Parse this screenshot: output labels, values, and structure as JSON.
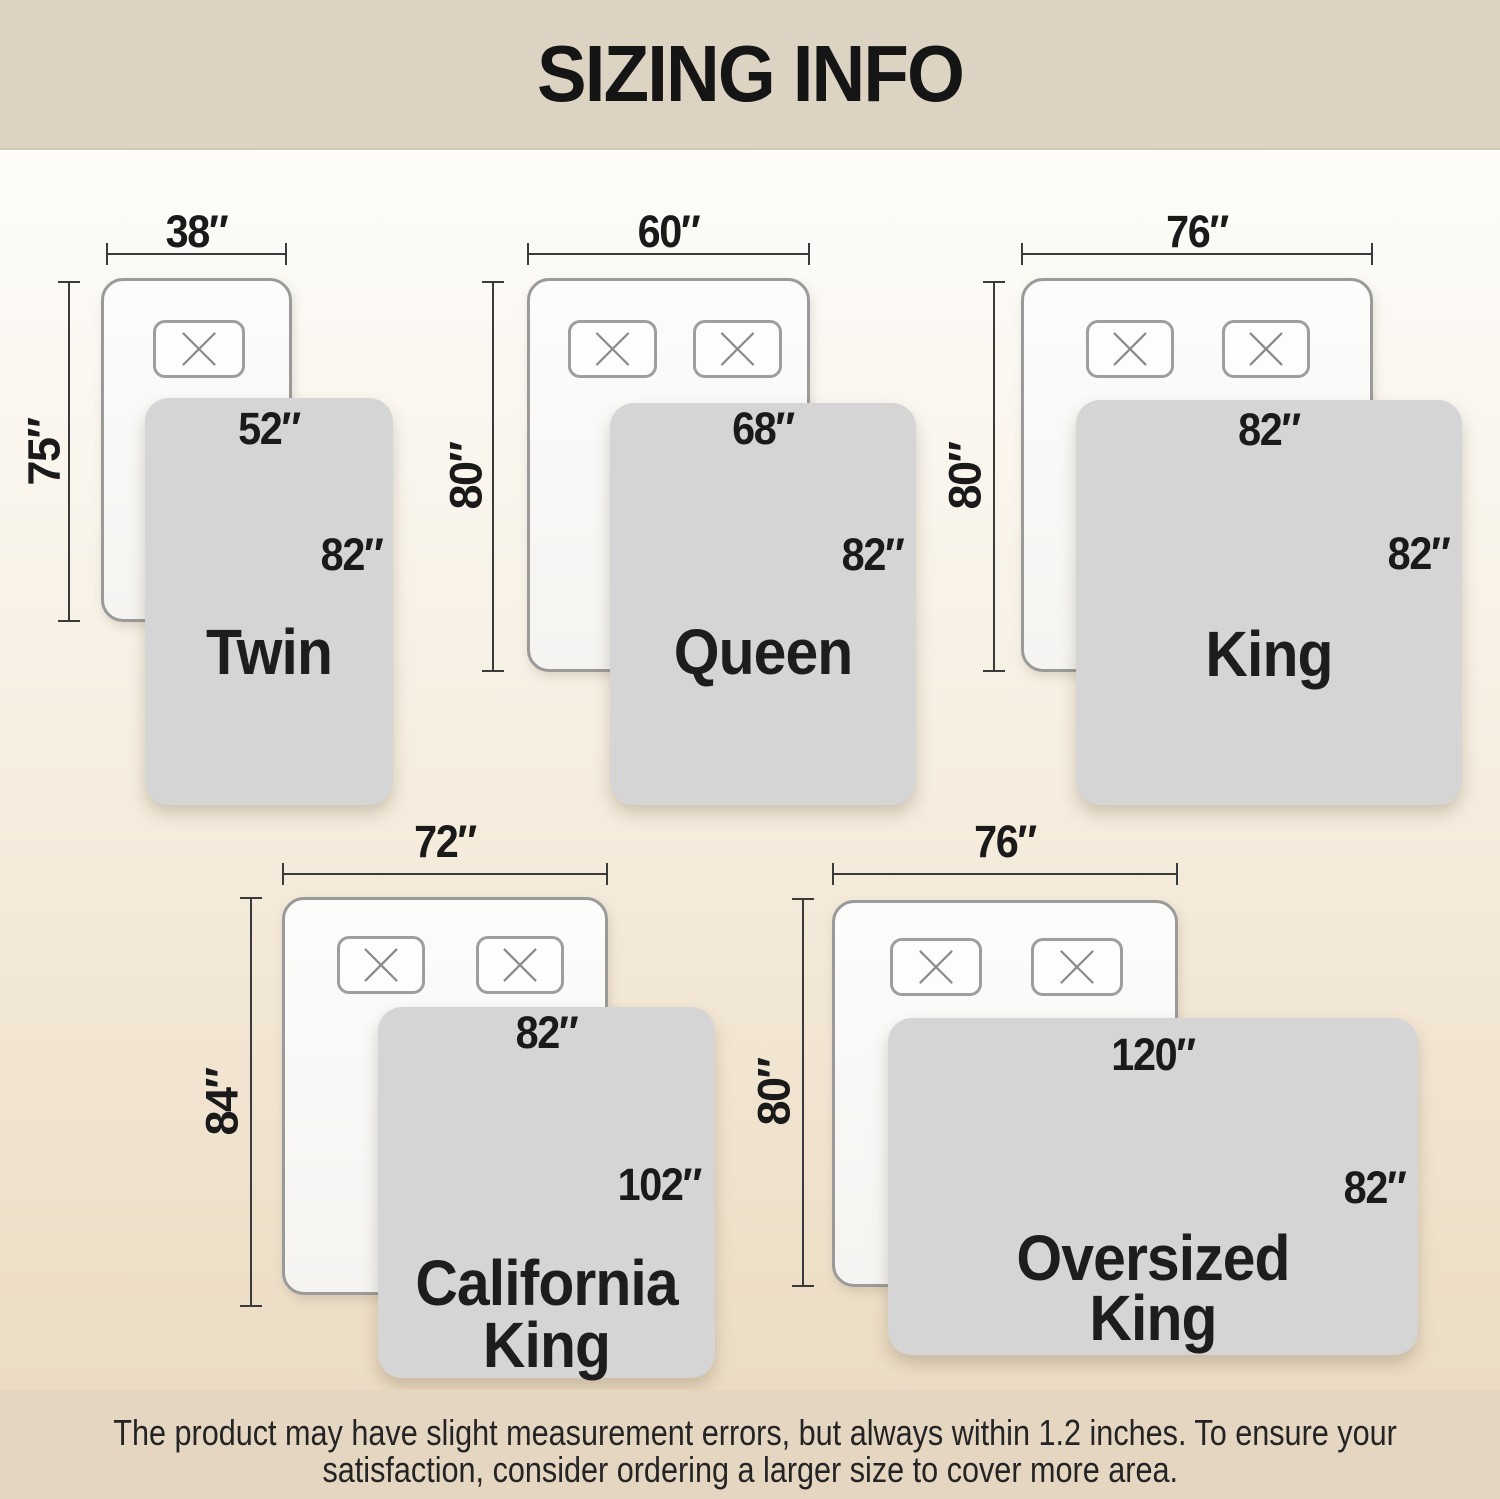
{
  "title": "SIZING INFO",
  "disclaimer": {
    "line1": "The product may have slight measurement errors, but always within 1.2 inches. To ensure your",
    "line2": "satisfaction, consider ordering a larger size to cover more area."
  },
  "colors": {
    "banner_bg": "#ddd3c2",
    "band_bg": "#e5d6c1",
    "page_gradient_top": "#ffffff",
    "page_gradient_bottom": "#eadac2",
    "blanket_gray": "#d5d5d6",
    "mattress_border": "#9a9a9a",
    "dimension_line": "#3a3a3a",
    "text": "#1a1a1a"
  },
  "beds": [
    {
      "name_line1": "Twin",
      "width": "38″",
      "length": "75″",
      "blanket_width": "52″",
      "blanket_length": "82″",
      "pillows": 1
    },
    {
      "name_line1": "Queen",
      "width": "60″",
      "length": "80″",
      "blanket_width": "68″",
      "blanket_length": "82″",
      "pillows": 2
    },
    {
      "name_line1": "King",
      "width": "76″",
      "length": "80″",
      "blanket_width": "82″",
      "blanket_length": "82″",
      "pillows": 2
    },
    {
      "name_line1": "California",
      "name_line2": "King",
      "width": "72″",
      "length": "84″",
      "blanket_width": "82″",
      "blanket_length": "102″",
      "pillows": 2
    },
    {
      "name_line1": "Oversized",
      "name_line2": "King",
      "width": "76″",
      "length": "80″",
      "blanket_width": "120″",
      "blanket_length": "82″",
      "pillows": 2
    }
  ]
}
